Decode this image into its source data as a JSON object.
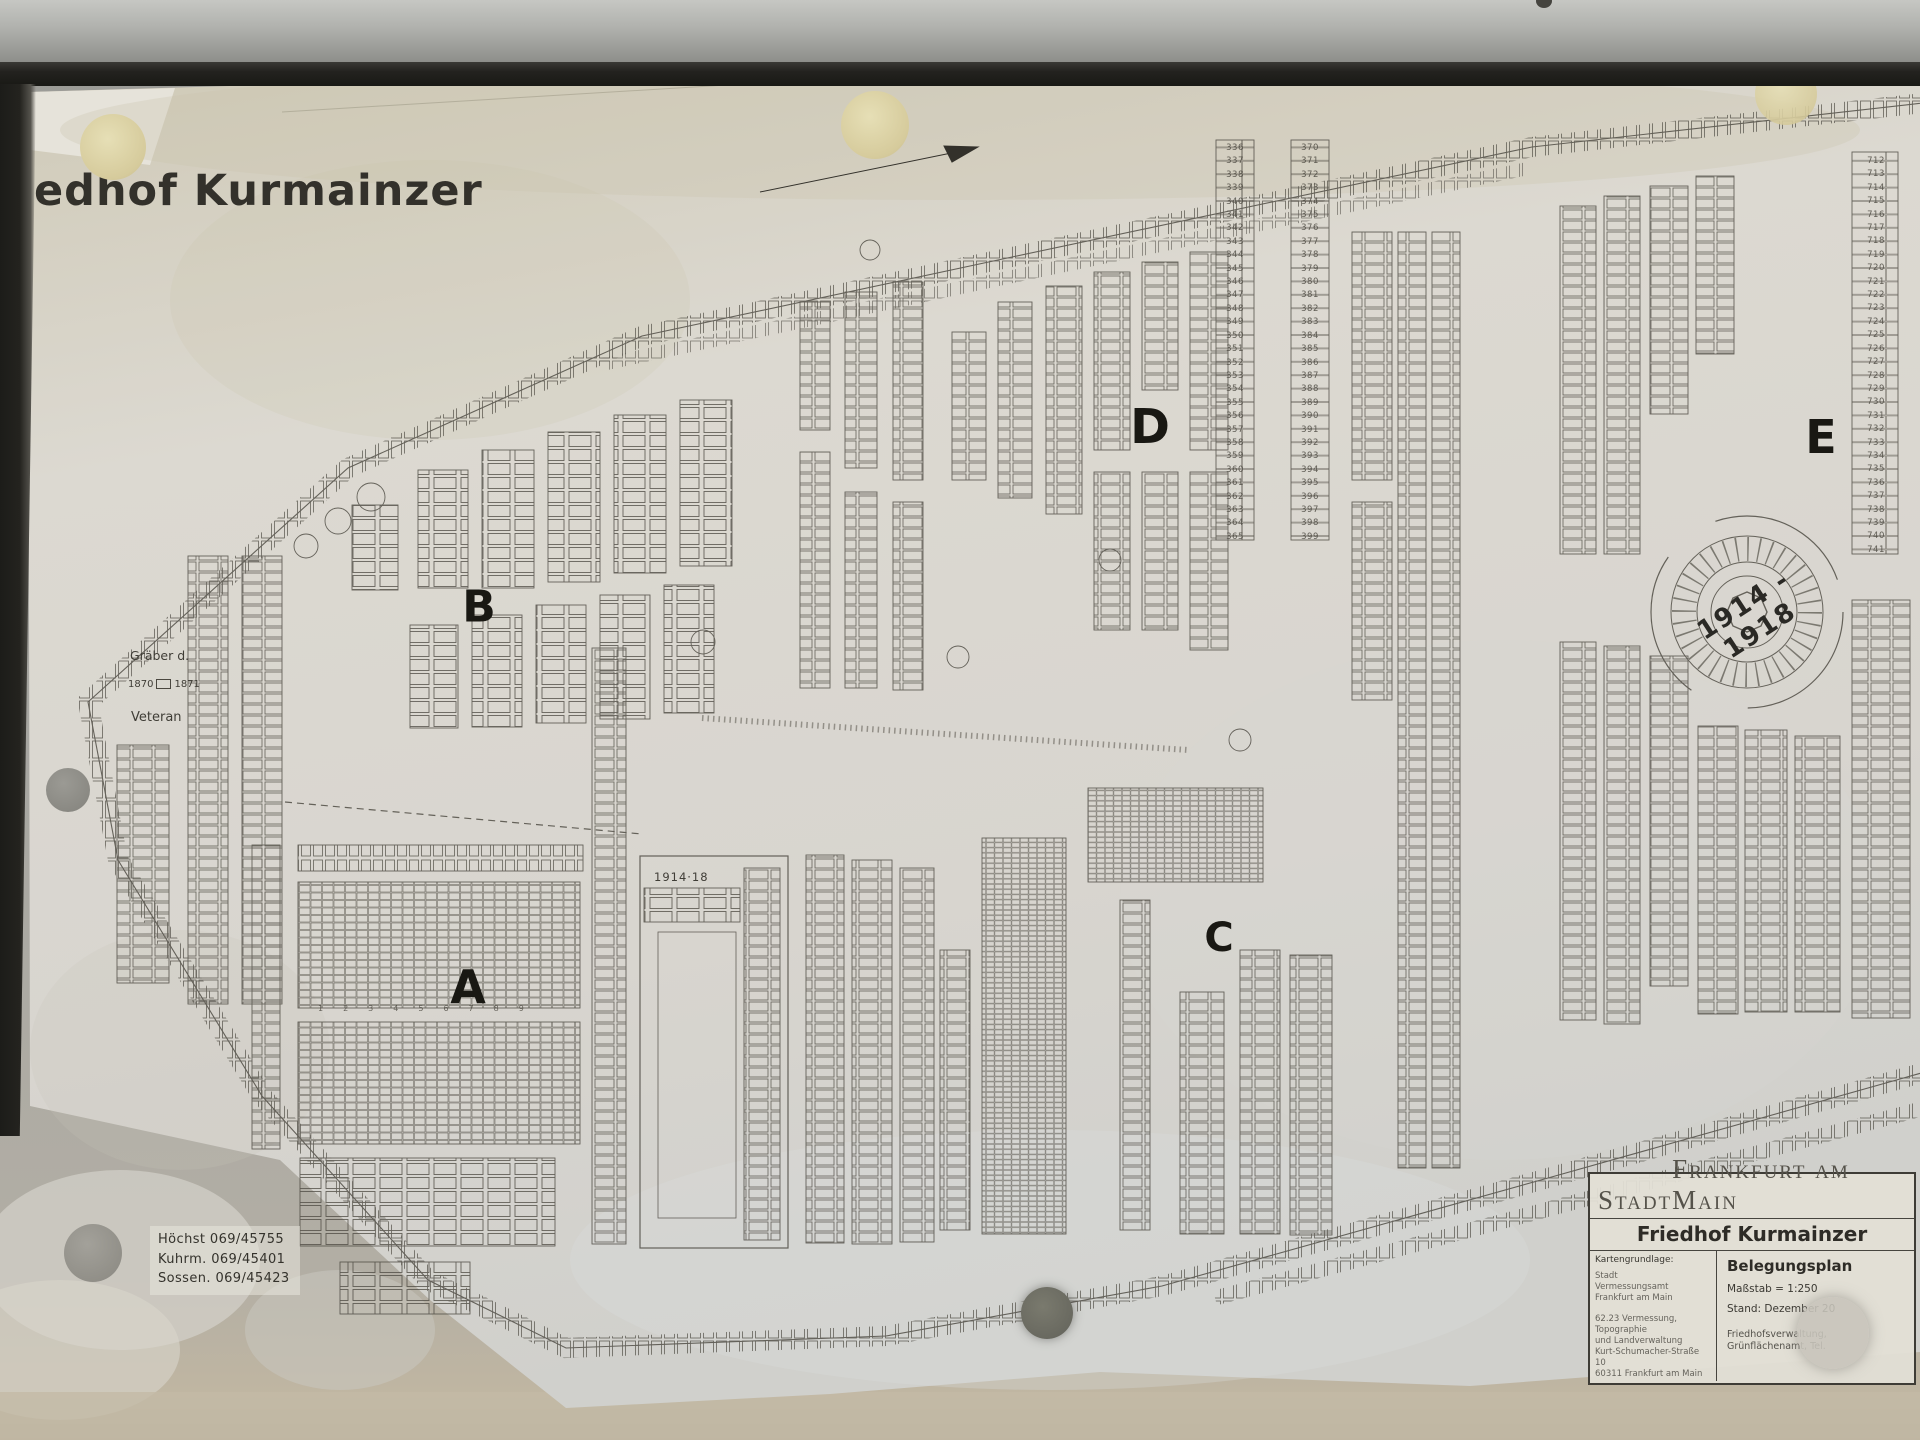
{
  "photo": {
    "title_partial": "edhof Kurmainzer",
    "sections": {
      "a": "A",
      "b": "B",
      "c": "C",
      "d": "D",
      "e": "E"
    },
    "memorial_label": "1914 - 1918",
    "war_graves_label": "1914·18",
    "left_labels": {
      "graeber": "Gräber d.",
      "year_from": "1870",
      "year_to": "1871",
      "veteran": "Veteran"
    },
    "phone_block": "Höchst  069/45755\nKuhrm. 069/45401\nSossen. 069/45423",
    "row_numbers": "123456789",
    "number_columns": {
      "col1": "336\n337\n338\n339\n340\n341\n342\n343\n344\n345\n346\n347\n348\n349\n350\n351\n352\n353\n354\n355\n356\n357\n358\n359\n360\n361\n362\n363\n364\n365",
      "col2": "370\n371\n372\n373\n374\n375\n376\n377\n378\n379\n380\n381\n382\n383\n384\n385\n386\n387\n388\n389\n390\n391\n392\n393\n394\n395\n396\n397\n398\n399",
      "col3": "712\n713\n714\n715\n716\n717\n718\n719\n720\n721\n722\n723\n724\n725\n726\n727\n728\n729\n730\n731\n732\n733\n734\n735\n736\n737\n738\n739\n740\n741"
    },
    "legend": {
      "city_word1": "Stadt",
      "city_word2": "Frankfurt am Main",
      "subtitle": "Friedhof Kurmainzer",
      "map_basis_label": "Kartengrundlage:",
      "map_basis_lines": "Stadt\nVermessungsamt\nFrankfurt am Main",
      "dept_lines": "62.23 Vermessung, Topographie\nund Landverwaltung\nKurt-Schumacher-Straße 10\n60311 Frankfurt am Main",
      "plan_type": "Belegungsplan",
      "scale": "Maßstab = 1:250",
      "date": "Stand: Dezember 20",
      "admin_lines": "Friedhofsverwaltung,\nGrünflächenamt,   Tel."
    },
    "icons": {
      "lock": "lock-cylinder-with-key-slot"
    },
    "colors": {
      "paper": "#d9d6cd",
      "ink": "#4b4840",
      "frame": "#23221f",
      "rail": "#b0b1ad",
      "backing": "#a8a7a2",
      "pad_cream": "#ddd3a6"
    }
  }
}
